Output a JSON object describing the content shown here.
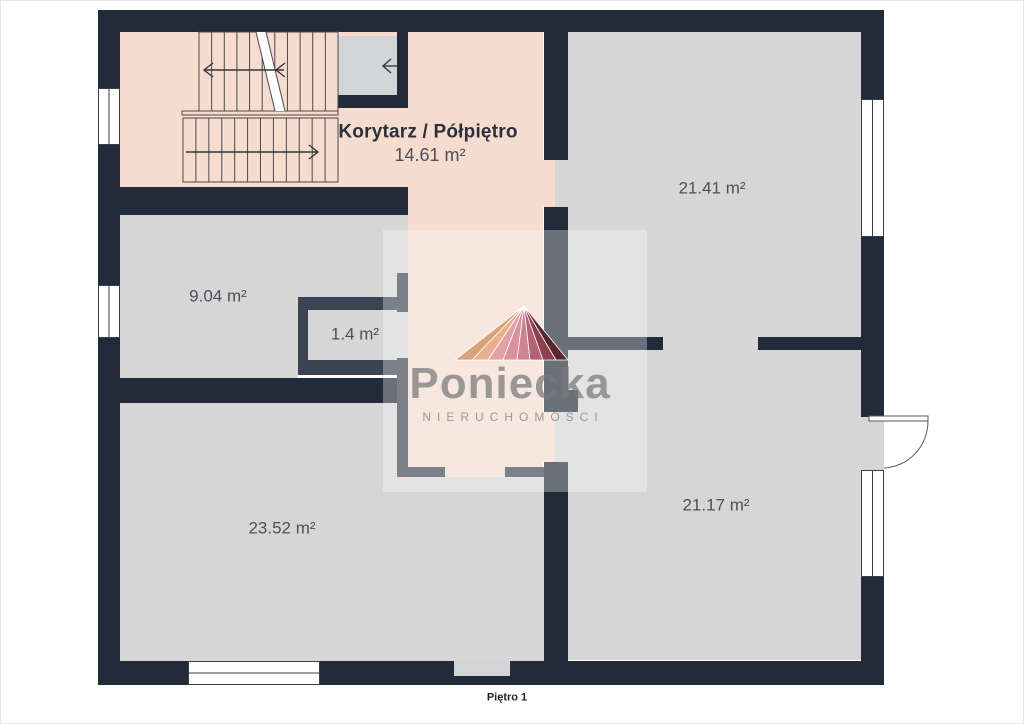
{
  "footer": {
    "floor_label": "Piętro 1"
  },
  "watermark": {
    "brand": "Poniecka",
    "subtitle": "NIERUCHOMOŚCI"
  },
  "rooms": [
    {
      "name": "Korytarz / Półpiętro",
      "area": "14.61 m²"
    },
    {
      "name": "",
      "area": "21.41 m²"
    },
    {
      "name": "",
      "area": "9.04 m²"
    },
    {
      "name": "",
      "area": "1.4 m²"
    },
    {
      "name": "",
      "area": "23.52 m²"
    },
    {
      "name": "",
      "area": "21.17 m²"
    }
  ],
  "floorplan": {
    "colors": {
      "wall": "#212b39",
      "part": "#3b4452",
      "pink": "#f5dccf",
      "gray": "#d6d6d7",
      "lightgray": "#d3d4d5",
      "white": "#ffffff",
      "win_line": "#3a3f47",
      "stair_line": "#4a4a4a",
      "arrow": "#33363c",
      "door": "#555a62",
      "watermark_box": "rgba(255,255,255,0.33)"
    },
    "rects": [
      {
        "x": 120,
        "y": 32,
        "w": 423,
        "h": 158,
        "c": "pink",
        "n": "floor-corridor-stairs"
      },
      {
        "x": 408,
        "y": 190,
        "w": 135,
        "h": 277,
        "c": "pink",
        "n": "floor-corridor-column"
      },
      {
        "x": 445,
        "y": 467,
        "w": 60,
        "h": 10,
        "c": "pink",
        "n": "floor-corridor-doorway"
      },
      {
        "x": 543,
        "y": 160,
        "w": 12,
        "h": 47,
        "c": "pink",
        "n": "floor-doorway-2141-a"
      },
      {
        "x": 555,
        "y": 160,
        "w": 13,
        "h": 47,
        "c": "gray",
        "n": "floor-doorway-2141-b"
      },
      {
        "x": 543,
        "y": 412,
        "w": 12,
        "h": 50,
        "c": "pink",
        "n": "floor-doorway-2117-a"
      },
      {
        "x": 555,
        "y": 412,
        "w": 13,
        "h": 50,
        "c": "gray",
        "n": "floor-doorway-2117-b"
      },
      {
        "x": 338,
        "y": 36,
        "w": 59,
        "h": 59,
        "c": "lightgray",
        "n": "floor-closet"
      },
      {
        "x": 120,
        "y": 215,
        "w": 288,
        "h": 82,
        "c": "gray",
        "n": "floor-room-904-upper"
      },
      {
        "x": 120,
        "y": 297,
        "w": 178,
        "h": 81,
        "c": "gray",
        "n": "floor-room-904-lower"
      },
      {
        "x": 308,
        "y": 310,
        "w": 89,
        "h": 50,
        "c": "gray",
        "n": "floor-room-14"
      },
      {
        "x": 397,
        "y": 312,
        "w": 11,
        "h": 46,
        "c": "gray",
        "n": "floor-doorway-14"
      },
      {
        "x": 567,
        "y": 32,
        "w": 294,
        "h": 305,
        "c": "gray",
        "n": "floor-room-2141"
      },
      {
        "x": 663,
        "y": 337,
        "w": 95,
        "h": 13,
        "c": "gray",
        "n": "floor-doorway-between-rooms"
      },
      {
        "x": 567,
        "y": 350,
        "w": 294,
        "h": 310,
        "c": "gray",
        "n": "floor-room-2117"
      },
      {
        "x": 861,
        "y": 417,
        "w": 23,
        "h": 53,
        "c": "gray",
        "n": "floor-balcony-threshold"
      },
      {
        "x": 120,
        "y": 403,
        "w": 277,
        "h": 258,
        "c": "gray",
        "n": "floor-room-2352-main"
      },
      {
        "x": 397,
        "y": 477,
        "w": 148,
        "h": 184,
        "c": "gray",
        "n": "floor-room-2352-lower"
      },
      {
        "x": 98,
        "y": 10,
        "w": 786,
        "h": 22,
        "c": "wall",
        "n": "wall-top"
      },
      {
        "x": 98,
        "y": 10,
        "w": 22,
        "h": 78,
        "c": "wall",
        "n": "wall-left-a"
      },
      {
        "x": 98,
        "y": 145,
        "w": 22,
        "h": 140,
        "c": "wall",
        "n": "wall-left-b"
      },
      {
        "x": 98,
        "y": 338,
        "w": 22,
        "h": 347,
        "c": "wall",
        "n": "wall-left-c"
      },
      {
        "x": 861,
        "y": 10,
        "w": 23,
        "h": 89,
        "c": "wall",
        "n": "wall-right-a"
      },
      {
        "x": 861,
        "y": 237,
        "w": 23,
        "h": 180,
        "c": "wall",
        "n": "wall-right-b"
      },
      {
        "x": 861,
        "y": 577,
        "w": 23,
        "h": 108,
        "c": "wall",
        "n": "wall-right-c"
      },
      {
        "x": 98,
        "y": 661,
        "w": 90,
        "h": 24,
        "c": "wall",
        "n": "wall-bottom-a"
      },
      {
        "x": 320,
        "y": 661,
        "w": 564,
        "h": 24,
        "c": "wall",
        "n": "wall-bottom-b"
      },
      {
        "x": 98,
        "y": 187,
        "w": 310,
        "h": 28,
        "c": "wall",
        "n": "wall-stairs-bottom"
      },
      {
        "x": 98,
        "y": 378,
        "w": 310,
        "h": 25,
        "c": "wall",
        "n": "wall-904-bottom"
      },
      {
        "x": 338,
        "y": 95,
        "w": 70,
        "h": 13,
        "c": "wall",
        "n": "wall-closet-bottom"
      },
      {
        "x": 397,
        "y": 32,
        "w": 11,
        "h": 76,
        "c": "wall",
        "n": "wall-closet-right"
      },
      {
        "x": 544,
        "y": 32,
        "w": 24,
        "h": 128,
        "c": "wall",
        "n": "wall-mid-a"
      },
      {
        "x": 544,
        "y": 207,
        "w": 24,
        "h": 143,
        "c": "wall",
        "n": "wall-mid-b"
      },
      {
        "x": 544,
        "y": 350,
        "w": 24,
        "h": 62,
        "c": "wall",
        "n": "wall-mid-c"
      },
      {
        "x": 568,
        "y": 390,
        "w": 10,
        "h": 22,
        "c": "wall",
        "n": "wall-mid-jamb"
      },
      {
        "x": 544,
        "y": 462,
        "w": 24,
        "h": 199,
        "c": "wall",
        "n": "wall-mid-d"
      },
      {
        "x": 568,
        "y": 337,
        "w": 95,
        "h": 13,
        "c": "wall",
        "n": "wall-between-2141-2117-a"
      },
      {
        "x": 758,
        "y": 337,
        "w": 103,
        "h": 13,
        "c": "wall",
        "n": "wall-between-2141-2117-b"
      },
      {
        "x": 298,
        "y": 297,
        "w": 110,
        "h": 13,
        "c": "part",
        "n": "wall-14-top"
      },
      {
        "x": 298,
        "y": 297,
        "w": 10,
        "h": 78,
        "c": "part",
        "n": "wall-14-left"
      },
      {
        "x": 298,
        "y": 360,
        "w": 110,
        "h": 15,
        "c": "part",
        "n": "wall-14-bottom"
      },
      {
        "x": 397,
        "y": 273,
        "w": 11,
        "h": 39,
        "c": "part",
        "n": "wall-corridor-stub"
      },
      {
        "x": 397,
        "y": 358,
        "w": 11,
        "h": 119,
        "c": "part",
        "n": "wall-corridor-left"
      },
      {
        "x": 397,
        "y": 467,
        "w": 48,
        "h": 10,
        "c": "part",
        "n": "wall-corridor-bottom-a"
      },
      {
        "x": 505,
        "y": 467,
        "w": 39,
        "h": 10,
        "c": "part",
        "n": "wall-corridor-bottom-b"
      },
      {
        "x": 454,
        "y": 661,
        "w": 56,
        "h": 15,
        "c": "lightgray",
        "n": "door-opening-bottom"
      }
    ],
    "windows": [
      {
        "x": 98,
        "y": 88,
        "w": 22,
        "h": 57,
        "o": "v",
        "n": "window-left-1"
      },
      {
        "x": 98,
        "y": 285,
        "w": 22,
        "h": 53,
        "o": "v",
        "n": "window-left-2"
      },
      {
        "x": 861,
        "y": 99,
        "w": 23,
        "h": 138,
        "o": "v",
        "n": "window-right-1"
      },
      {
        "x": 861,
        "y": 470,
        "w": 23,
        "h": 107,
        "o": "v",
        "n": "window-right-2"
      },
      {
        "x": 188,
        "y": 661,
        "w": 132,
        "h": 24,
        "o": "h",
        "n": "window-bottom"
      }
    ],
    "stairs": {
      "flights": [
        {
          "x1": 199,
          "y1": 32,
          "x2": 338,
          "y2": 111,
          "steps": 11,
          "n": "stairs-upper-flight"
        },
        {
          "x1": 183,
          "y1": 118,
          "x2": 338,
          "y2": 182,
          "steps": 12,
          "n": "stairs-lower-flight"
        }
      ],
      "stringer": {
        "x": 182,
        "y": 111,
        "w": 156,
        "h": 4
      },
      "break_band": {
        "points": "256,32 266,32 285,111 275,111",
        "edge1": [
          256,
          32,
          275,
          111
        ],
        "edge2": [
          266,
          32,
          285,
          111
        ]
      },
      "arrows": [
        {
          "n": "stairs-up-arrow",
          "line": [
            204,
            70,
            284,
            70
          ],
          "chevrons": [
            "213,63 204,70 213,77",
            "285,63 276,70 285,77"
          ]
        },
        {
          "n": "stairs-down-arrow",
          "line": [
            186,
            152,
            318,
            152
          ],
          "chevrons": [
            "309,145 318,152 309,159"
          ]
        },
        {
          "n": "closet-arrow",
          "line": [
            383,
            66,
            397,
            66
          ],
          "chevrons": [
            "391,59 383,66 391,73"
          ]
        }
      ]
    },
    "door": {
      "leaf": {
        "x": 869,
        "y": 416,
        "w": 59,
        "h": 5
      },
      "arc": "M 928 421 A 46 47 0 0 1 884 468"
    },
    "watermark_box": {
      "x": 383,
      "y": 230,
      "w": 264,
      "h": 262
    },
    "logo": {
      "apex": [
        524,
        306
      ],
      "base_y": 360,
      "stops": [
        455,
        472,
        488,
        503,
        517,
        530,
        543,
        556,
        568
      ],
      "colors": [
        "#d9a379",
        "#e6b28c",
        "#e2a2a4",
        "#d9929b",
        "#cc8490",
        "#b26274",
        "#8c3f4c",
        "#5c2630"
      ]
    }
  }
}
